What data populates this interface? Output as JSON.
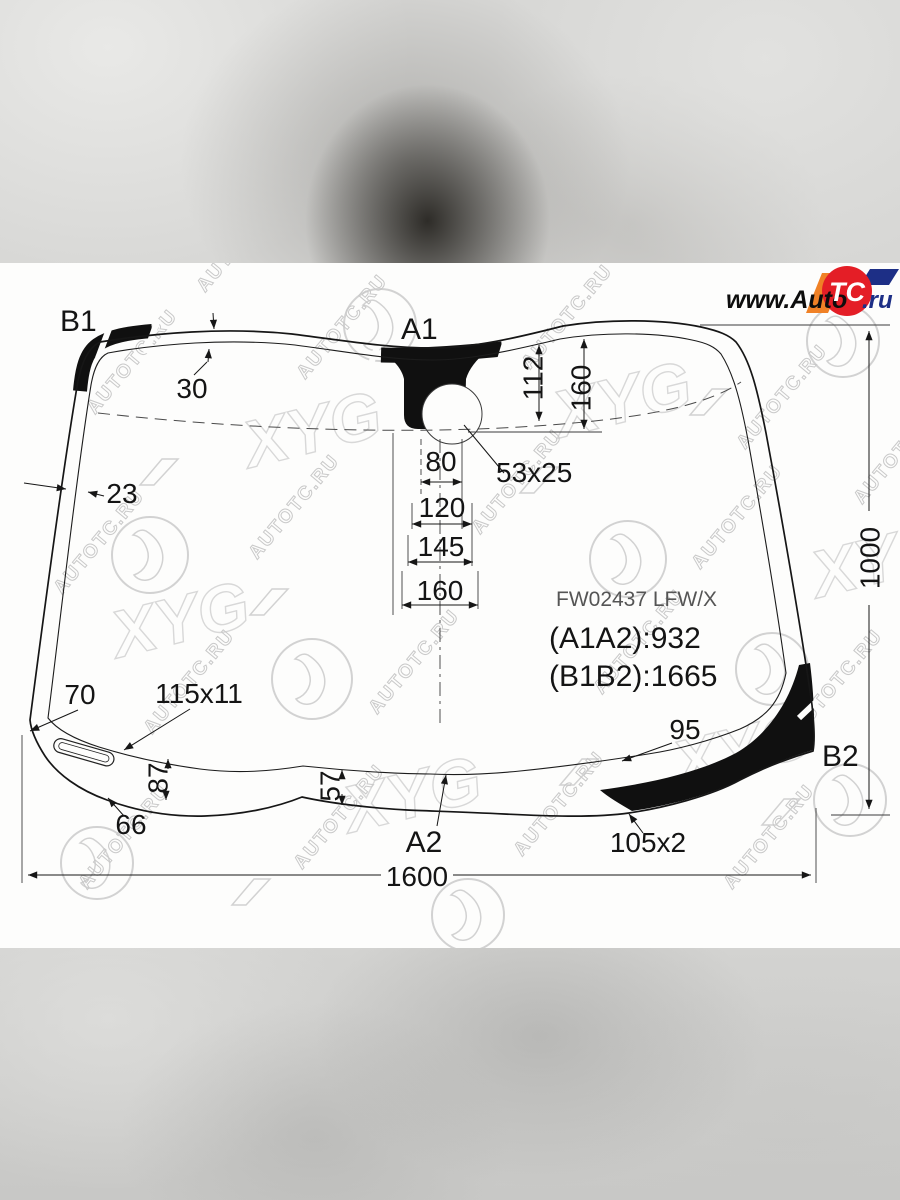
{
  "logo": {
    "www": "www.Auto",
    "tc": "TC",
    "ru": ".ru"
  },
  "watermark": {
    "site": "AUTOTC.RU",
    "brand": "XYG"
  },
  "points": {
    "b1": "B1",
    "a1": "A1",
    "a2": "A2",
    "b2": "B2"
  },
  "part": {
    "code": "FW02437 LFW/X",
    "a1a2": "(A1A2):932",
    "b1b2": "(B1B2):1665"
  },
  "dims": {
    "band_top": "30",
    "band_side": "23",
    "v112": "112",
    "v160": "160",
    "sensor": "53x25",
    "w80": "80",
    "w120": "120",
    "w145": "145",
    "w160": "160",
    "height": "1000",
    "d70": "70",
    "slot": "115x11",
    "d95": "95",
    "d87": "87",
    "d57": "57",
    "d66": "66",
    "d105": "105x2",
    "width": "1600"
  },
  "colors": {
    "red": "#e41e26",
    "orange": "#f08126",
    "navy": "#1d2f86",
    "line": "#161616"
  }
}
